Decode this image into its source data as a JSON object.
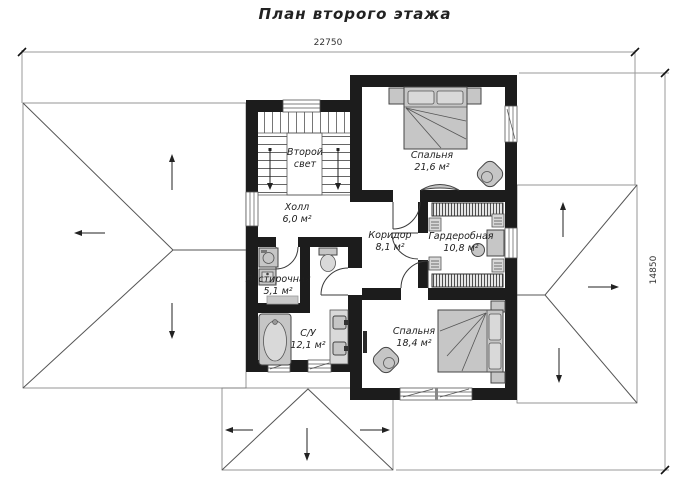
{
  "title": "План второго этажа",
  "dimensions": {
    "width_mm": "22750",
    "height_mm": "14850"
  },
  "rooms": [
    {
      "id": "second-light",
      "name": "Второй свет",
      "area": ""
    },
    {
      "id": "hall",
      "name": "Холл",
      "area": "6,0 м²"
    },
    {
      "id": "bedroom-top",
      "name": "Спальня",
      "area": "21,6 м²"
    },
    {
      "id": "corridor",
      "name": "Коридор",
      "area": "8,1 м²"
    },
    {
      "id": "wardrobe",
      "name": "Гардеробная",
      "area": "10,8 м²"
    },
    {
      "id": "laundry",
      "name": "Постирочная",
      "area": "5,1 м²"
    },
    {
      "id": "bathroom",
      "name": "С/У",
      "area": "12,1 м²"
    },
    {
      "id": "bedroom-bottom",
      "name": "Спальня",
      "area": "18,4 м²"
    }
  ],
  "colors": {
    "wall": "#1c1c1c",
    "roof": "#a0a0a0",
    "furniture": "#c6c6c6",
    "text": "#1e1e1e"
  }
}
